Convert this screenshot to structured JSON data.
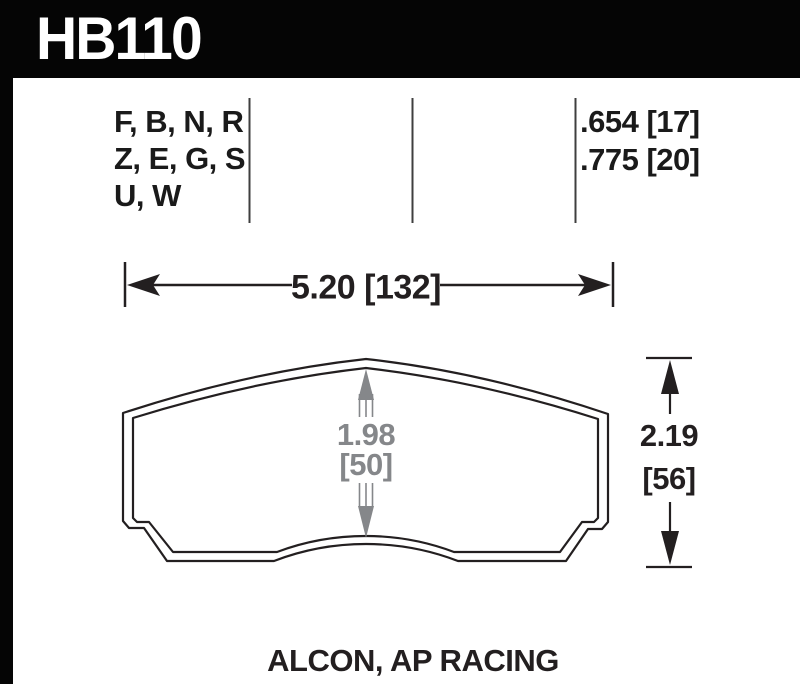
{
  "header": {
    "part_number": "HB110",
    "bar_color": "#050505",
    "text_color": "#ffffff"
  },
  "spec_table": {
    "compound_rows": [
      "F, B, N, R",
      "Z, E, G, S",
      "U, W"
    ],
    "thickness_rows": [
      ".654 [17]",
      ".775 [20]"
    ]
  },
  "dimensions": {
    "width_label": "5.20 [132]",
    "height_label_line1": "2.19",
    "height_label_line2": "[56]",
    "center_height_line1": "1.98",
    "center_height_line2": "[50]"
  },
  "footer": {
    "applications": "ALCON, AP RACING"
  },
  "colors": {
    "line": "#231f20",
    "dimension_gray": "#85878a",
    "divider": "#3f3f3f"
  }
}
